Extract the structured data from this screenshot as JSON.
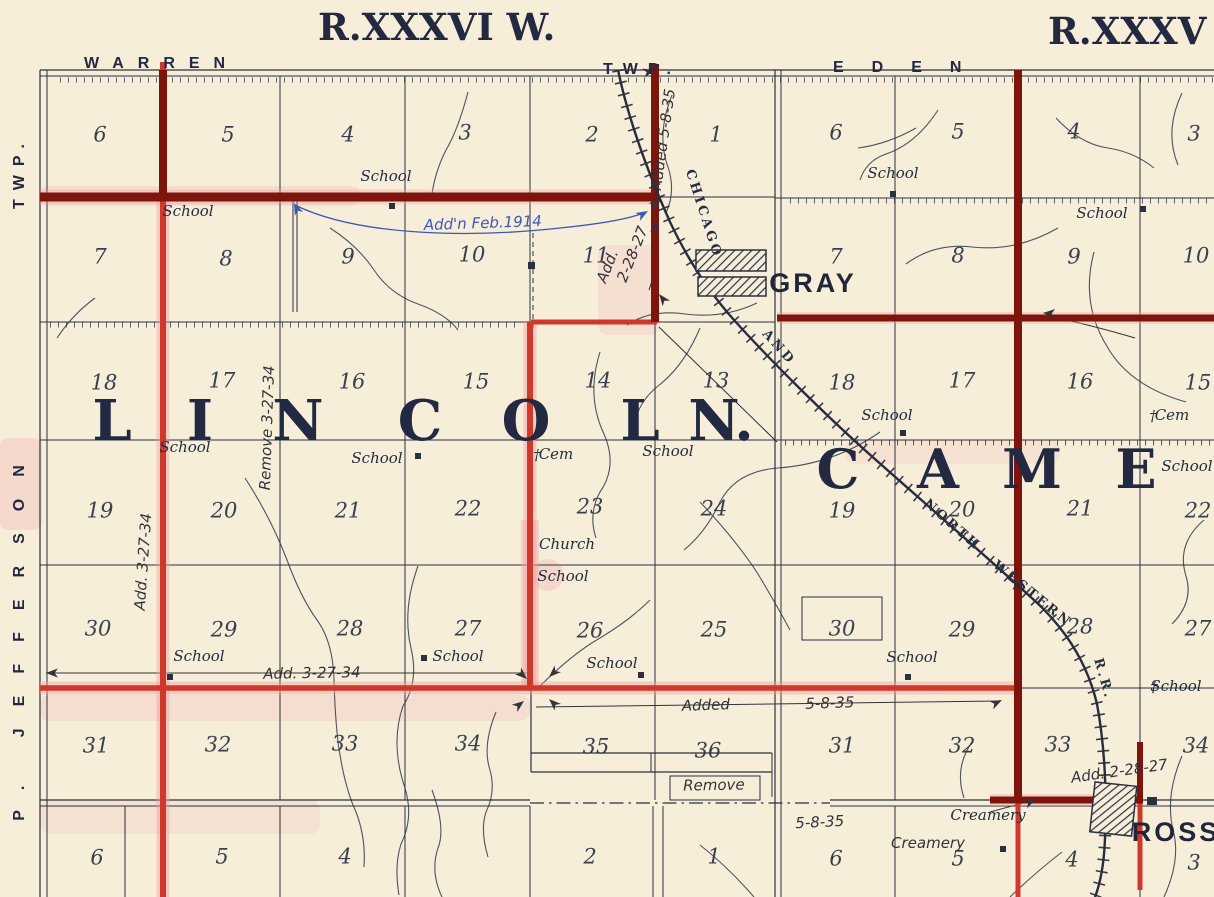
{
  "colors": {
    "paper": "#f7eeda",
    "ink": "#2b3040",
    "red_bright": "#cf392c",
    "red_dark": "#7e150d",
    "pink_halo": "#ef9f9f",
    "blue_ink": "#3d57b5"
  },
  "titles": {
    "range_left": "R.XXXVI W.",
    "range_right": "R.XXXV",
    "warren": "WARREN",
    "twp_abbrev": "TWP.",
    "eden": "EDEN",
    "west_top": "TWP.",
    "west_bottom": "P. JEFFERSON",
    "west_fragment": "ION.",
    "gray_town": "GRAY",
    "ross_town": "ROSS"
  },
  "townships": {
    "lincoln": {
      "word": "LINCOLN.",
      "y": 440,
      "letters": [
        {
          "c": "L",
          "x": 112
        },
        {
          "c": "I",
          "x": 200
        },
        {
          "c": "N",
          "x": 298
        },
        {
          "c": "C",
          "x": 420
        },
        {
          "c": "O",
          "x": 526
        },
        {
          "c": "L",
          "x": 640
        },
        {
          "c": "N",
          "x": 714
        },
        {
          "c": ".",
          "x": 744
        }
      ]
    },
    "cameron": {
      "word": "CAME",
      "y": 488,
      "letters": [
        {
          "c": "C",
          "x": 838
        },
        {
          "c": "A",
          "x": 938
        },
        {
          "c": "M",
          "x": 1032
        },
        {
          "c": "E",
          "x": 1136
        }
      ]
    }
  },
  "railroad": {
    "name": "CHICAGO AND NORTH WESTERN R.R.",
    "label_parts": [
      {
        "t": "CHICAGO",
        "x": 700,
        "y": 215,
        "r": 72
      },
      {
        "t": "AND",
        "x": 776,
        "y": 350,
        "r": 48
      },
      {
        "t": "NORTH",
        "x": 950,
        "y": 528,
        "r": 41
      },
      {
        "t": "WESTERN",
        "x": 1030,
        "y": 597,
        "r": 39
      },
      {
        "t": "R.R.",
        "x": 1100,
        "y": 680,
        "r": 74
      }
    ]
  },
  "sections": {
    "lincoln": [
      {
        "n": "6",
        "x": 100,
        "y": 136
      },
      {
        "n": "5",
        "x": 228,
        "y": 136
      },
      {
        "n": "4",
        "x": 348,
        "y": 136
      },
      {
        "n": "3",
        "x": 465,
        "y": 134
      },
      {
        "n": "2",
        "x": 592,
        "y": 136
      },
      {
        "n": "1",
        "x": 716,
        "y": 136
      },
      {
        "n": "7",
        "x": 100,
        "y": 258
      },
      {
        "n": "8",
        "x": 226,
        "y": 260
      },
      {
        "n": "9",
        "x": 348,
        "y": 258
      },
      {
        "n": "10",
        "x": 472,
        "y": 256
      },
      {
        "n": "11",
        "x": 596,
        "y": 257
      },
      {
        "n": "18",
        "x": 104,
        "y": 384
      },
      {
        "n": "17",
        "x": 222,
        "y": 382
      },
      {
        "n": "16",
        "x": 352,
        "y": 383
      },
      {
        "n": "15",
        "x": 476,
        "y": 383
      },
      {
        "n": "14",
        "x": 598,
        "y": 382
      },
      {
        "n": "13",
        "x": 716,
        "y": 382
      },
      {
        "n": "19",
        "x": 100,
        "y": 512
      },
      {
        "n": "20",
        "x": 224,
        "y": 512
      },
      {
        "n": "21",
        "x": 348,
        "y": 512
      },
      {
        "n": "22",
        "x": 468,
        "y": 510
      },
      {
        "n": "23",
        "x": 590,
        "y": 508
      },
      {
        "n": "24",
        "x": 714,
        "y": 510
      },
      {
        "n": "30",
        "x": 98,
        "y": 630
      },
      {
        "n": "29",
        "x": 224,
        "y": 631
      },
      {
        "n": "28",
        "x": 350,
        "y": 630
      },
      {
        "n": "27",
        "x": 468,
        "y": 630
      },
      {
        "n": "26",
        "x": 590,
        "y": 632
      },
      {
        "n": "25",
        "x": 714,
        "y": 631
      },
      {
        "n": "31",
        "x": 96,
        "y": 747
      },
      {
        "n": "32",
        "x": 218,
        "y": 746
      },
      {
        "n": "33",
        "x": 345,
        "y": 745
      },
      {
        "n": "34",
        "x": 468,
        "y": 745
      },
      {
        "n": "35",
        "x": 596,
        "y": 748
      },
      {
        "n": "36",
        "x": 708,
        "y": 752
      }
    ],
    "cameron": [
      {
        "n": "6",
        "x": 836,
        "y": 134
      },
      {
        "n": "5",
        "x": 958,
        "y": 133
      },
      {
        "n": "4",
        "x": 1074,
        "y": 133
      },
      {
        "n": "3",
        "x": 1194,
        "y": 135
      },
      {
        "n": "7",
        "x": 836,
        "y": 258
      },
      {
        "n": "8",
        "x": 958,
        "y": 257
      },
      {
        "n": "9",
        "x": 1074,
        "y": 258
      },
      {
        "n": "10",
        "x": 1196,
        "y": 257
      },
      {
        "n": "18",
        "x": 842,
        "y": 384
      },
      {
        "n": "17",
        "x": 962,
        "y": 382
      },
      {
        "n": "16",
        "x": 1080,
        "y": 383
      },
      {
        "n": "15",
        "x": 1198,
        "y": 384
      },
      {
        "n": "19",
        "x": 842,
        "y": 512
      },
      {
        "n": "20",
        "x": 962,
        "y": 511
      },
      {
        "n": "21",
        "x": 1080,
        "y": 510
      },
      {
        "n": "22",
        "x": 1198,
        "y": 512
      },
      {
        "n": "30",
        "x": 842,
        "y": 630
      },
      {
        "n": "29",
        "x": 962,
        "y": 631
      },
      {
        "n": "28",
        "x": 1080,
        "y": 628
      },
      {
        "n": "27",
        "x": 1198,
        "y": 630
      },
      {
        "n": "31",
        "x": 842,
        "y": 747
      },
      {
        "n": "32",
        "x": 962,
        "y": 747
      },
      {
        "n": "33",
        "x": 1058,
        "y": 746
      },
      {
        "n": "34",
        "x": 1196,
        "y": 747
      }
    ],
    "south": [
      {
        "n": "6",
        "x": 97,
        "y": 859
      },
      {
        "n": "5",
        "x": 222,
        "y": 858
      },
      {
        "n": "4",
        "x": 345,
        "y": 858
      },
      {
        "n": "2",
        "x": 590,
        "y": 858
      },
      {
        "n": "1",
        "x": 714,
        "y": 858
      },
      {
        "n": "6",
        "x": 836,
        "y": 860
      },
      {
        "n": "5",
        "x": 958,
        "y": 860
      },
      {
        "n": "4",
        "x": 1072,
        "y": 861
      },
      {
        "n": "3",
        "x": 1194,
        "y": 864
      }
    ]
  },
  "features": [
    {
      "t": "School",
      "x": 386,
      "y": 181,
      "sq": [
        392,
        206
      ]
    },
    {
      "t": "School",
      "x": 188,
      "y": 216
    },
    {
      "t": "School",
      "x": 185,
      "y": 452
    },
    {
      "t": "School",
      "x": 377,
      "y": 463,
      "sq": [
        418,
        456
      ]
    },
    {
      "t": "Cem",
      "x": 556,
      "y": 459,
      "cross": [
        537,
        459
      ]
    },
    {
      "t": "School",
      "x": 668,
      "y": 456
    },
    {
      "t": "Church",
      "x": 567,
      "y": 549
    },
    {
      "t": "School",
      "x": 563,
      "y": 581
    },
    {
      "t": "School",
      "x": 199,
      "y": 661,
      "sq": [
        170,
        677
      ]
    },
    {
      "t": "School",
      "x": 458,
      "y": 661,
      "sq": [
        424,
        658
      ]
    },
    {
      "t": "School",
      "x": 612,
      "y": 668,
      "sq": [
        641,
        675
      ]
    },
    {
      "t": "School",
      "x": 912,
      "y": 662,
      "sq": [
        908,
        677
      ]
    },
    {
      "t": "School",
      "x": 1176,
      "y": 691,
      "cross": [
        1154,
        691
      ]
    },
    {
      "t": "School",
      "x": 893,
      "y": 178,
      "sq": [
        893,
        194
      ]
    },
    {
      "t": "School",
      "x": 1102,
      "y": 218,
      "sq": [
        1143,
        209
      ]
    },
    {
      "t": "School",
      "x": 887,
      "y": 420,
      "sq": [
        903,
        433
      ]
    },
    {
      "t": "Cem",
      "x": 1172,
      "y": 420,
      "cross": [
        1153,
        420
      ]
    },
    {
      "t": "School",
      "x": 1187,
      "y": 471
    },
    {
      "t": "Creamery",
      "x": 988,
      "y": 820
    },
    {
      "t": "Creamery",
      "x": 928,
      "y": 848,
      "sq": [
        1003,
        849
      ],
      "hand": true
    }
  ],
  "annotations": [
    {
      "t": "Add'n Feb.1914",
      "x": 483,
      "y": 228,
      "r": -2,
      "s": 15,
      "blue": true
    },
    {
      "t": "Added 5-8-35",
      "x": 668,
      "y": 140,
      "r": -82,
      "s": 14
    },
    {
      "t": "Add.",
      "x": 612,
      "y": 268,
      "r": -68,
      "s": 14
    },
    {
      "t": "2-28-27",
      "x": 637,
      "y": 256,
      "r": -68,
      "s": 12
    },
    {
      "t": "Remove 3-27-34",
      "x": 272,
      "y": 428,
      "r": -88,
      "s": 14
    },
    {
      "t": "Add. 3-27-34",
      "x": 148,
      "y": 562,
      "r": -86,
      "s": 14
    },
    {
      "t": "Add.  3-27-34",
      "x": 312,
      "y": 678,
      "r": -1,
      "s": 15
    },
    {
      "t": "Added",
      "x": 706,
      "y": 710,
      "r": -2,
      "s": 17
    },
    {
      "t": "5-8-35",
      "x": 830,
      "y": 708,
      "r": -2,
      "s": 15
    },
    {
      "t": "Remove",
      "x": 714,
      "y": 790,
      "r": -1,
      "s": 14
    },
    {
      "t": "5-8-35",
      "x": 820,
      "y": 827,
      "r": -3,
      "s": 13
    },
    {
      "t": "Add. 2-28-27",
      "x": 1120,
      "y": 776,
      "r": -8,
      "s": 13
    }
  ]
}
